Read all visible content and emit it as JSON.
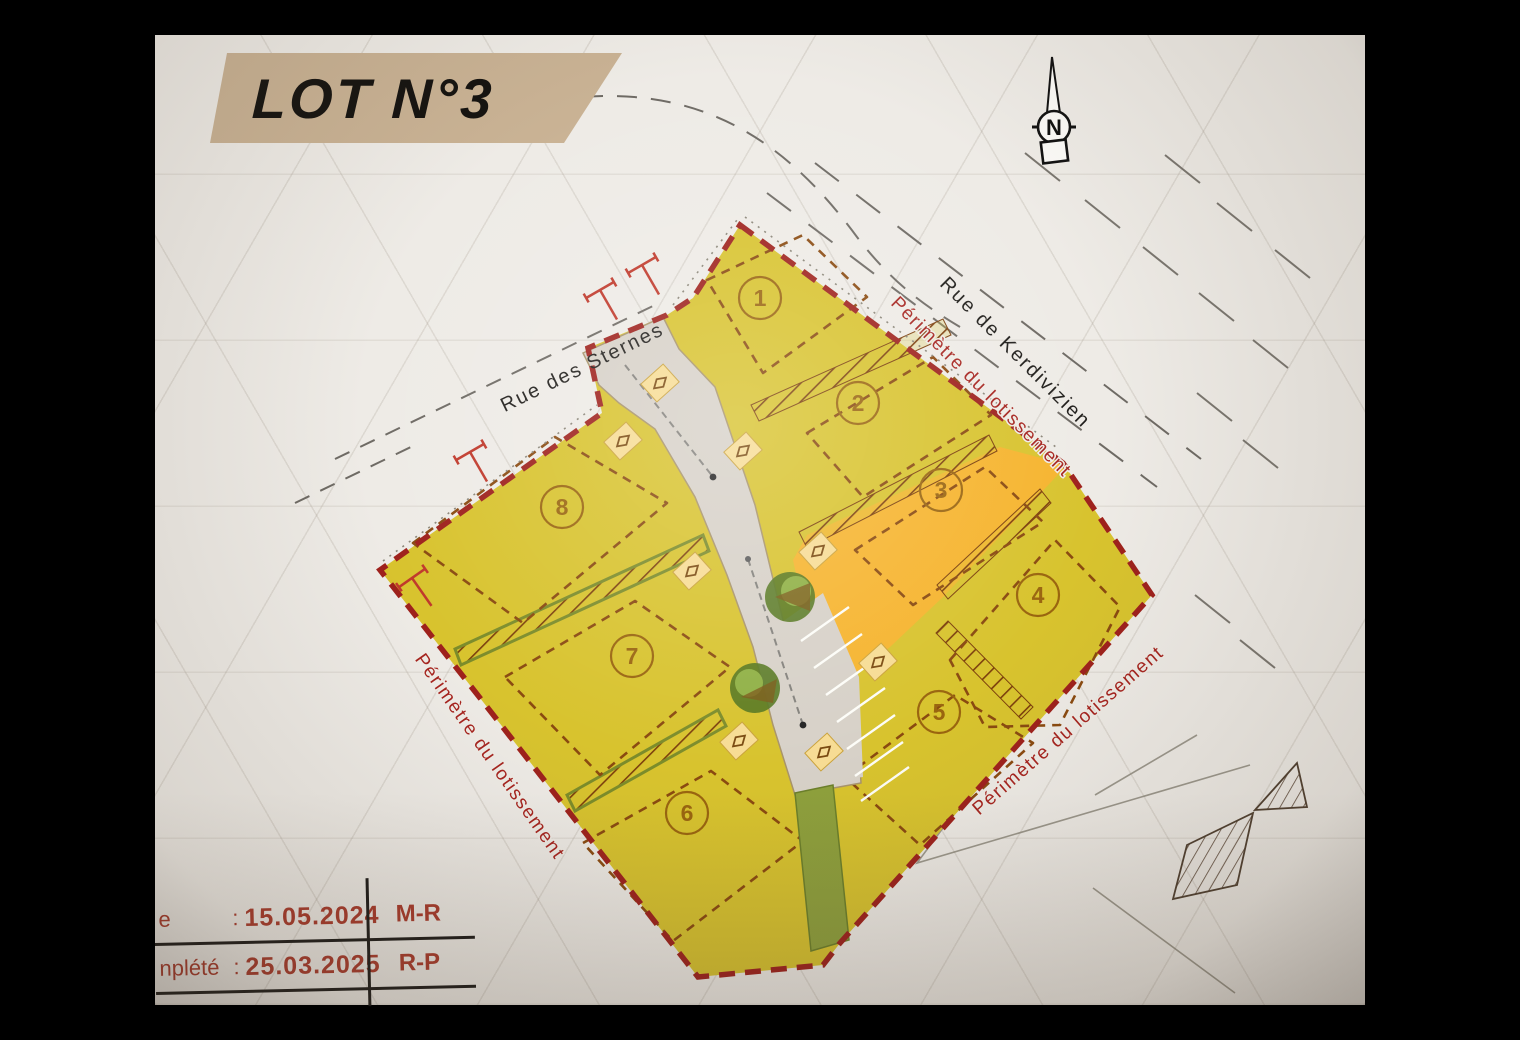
{
  "title": "LOT N°3",
  "compass": {
    "label": "N"
  },
  "streets": {
    "sternes": "Rue des Sternes",
    "kerdivizien": "Rue de Kerdivizien"
  },
  "perimeter": {
    "label": "Périmètre du lotissement"
  },
  "lots": [
    {
      "number": "1"
    },
    {
      "number": "2"
    },
    {
      "number": "3"
    },
    {
      "number": "4"
    },
    {
      "number": "5"
    },
    {
      "number": "6"
    },
    {
      "number": "7"
    },
    {
      "number": "8"
    }
  ],
  "legend_table": {
    "rows": [
      {
        "label": "e",
        "colon": ":",
        "date": "15.05.2024",
        "initials": "M-R"
      },
      {
        "label": "nplété",
        "colon": ":",
        "date": "25.03.2025",
        "initials": "R-P"
      }
    ]
  },
  "colors": {
    "paper": "#eeebe6",
    "banner_tan": "#c9b294",
    "lot_fill_yellow": "#d8c32e",
    "lot3_fill_orange": "#f6b42e",
    "road_grey": "#d7d1c8",
    "green_strip": "#8ea03c",
    "perimeter_red": "#9e211c",
    "table_text_red": "#a93a2b",
    "setback_dash_brown": "#8a4a10"
  }
}
